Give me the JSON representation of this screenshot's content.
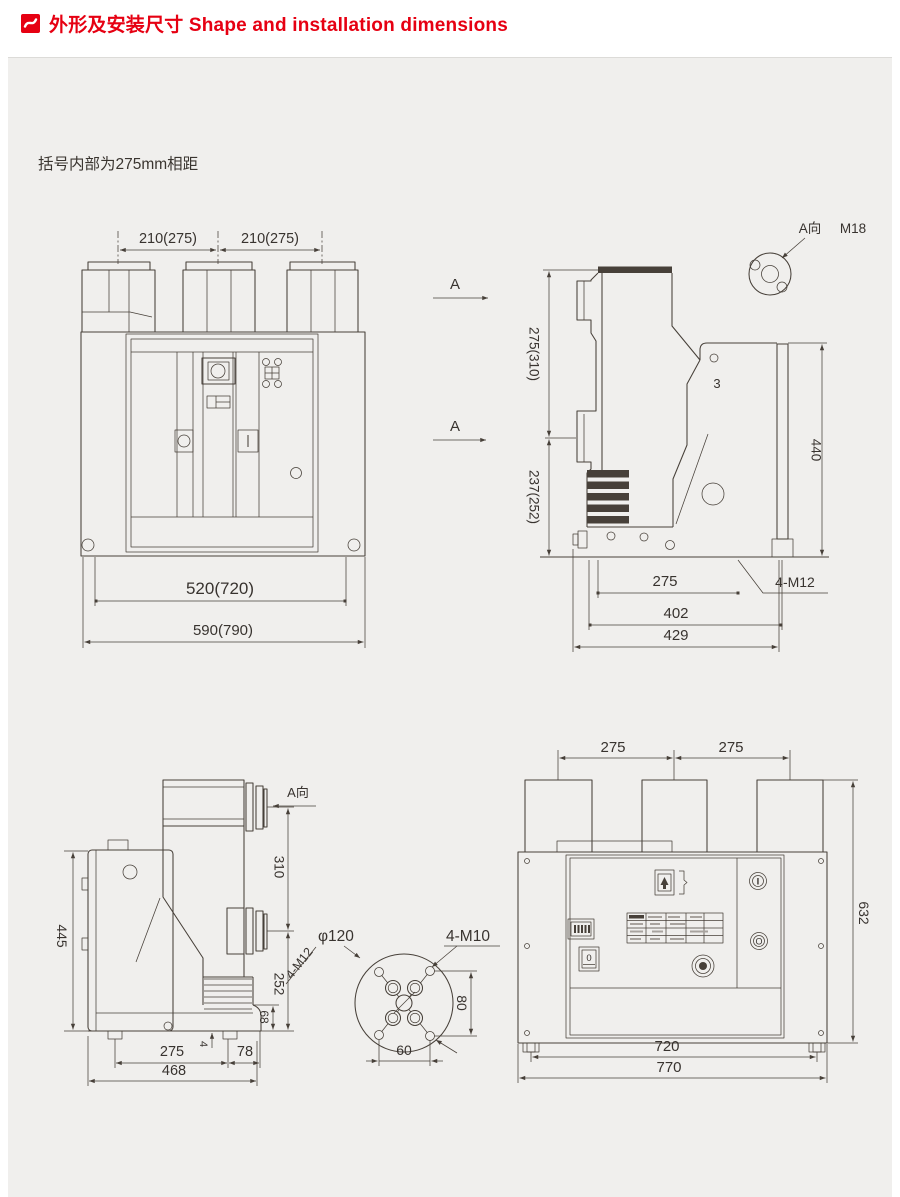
{
  "header": {
    "title": "外形及安装尺寸 Shape and installation dimensions"
  },
  "note": "括号内部为275mm相距",
  "colors": {
    "accent": "#e60012",
    "line": "#474039",
    "panel_bg": "#f0efed"
  },
  "front_view_top": {
    "pole_pitch_left": "210(275)",
    "pole_pitch_right": "210(275)",
    "hole_spacing": "520(720)",
    "overall_width": "590(790)"
  },
  "side_view_top": {
    "section_a_upper": "A",
    "section_a_lower": "A",
    "view_label": "A向",
    "thread": "M18",
    "pole_spacing": "275(310)",
    "lower_spacing": "237(252)",
    "height": "440",
    "plate_thickness": "3",
    "hole_pitch": "275",
    "depth_402": "402",
    "depth_429": "429",
    "bolts": "4-M12"
  },
  "side_view_bottom": {
    "view_label": "A向",
    "height": "445",
    "pole_spacing": "310",
    "lower": "252",
    "base": "68",
    "foot": "4",
    "bolts": "4-M12",
    "hole_pitch": "275",
    "offset_78": "78",
    "depth": "468"
  },
  "flange_detail": {
    "diameter": "φ120",
    "bolts": "4-M10",
    "vertical": "80",
    "horizontal": "60"
  },
  "front_view_bottom": {
    "pole_pitch_left": "275",
    "pole_pitch_right": "275",
    "height": "632",
    "hole_spacing": "720",
    "overall_width": "770",
    "close_button": "I",
    "open_button": "O",
    "counter": "0"
  }
}
